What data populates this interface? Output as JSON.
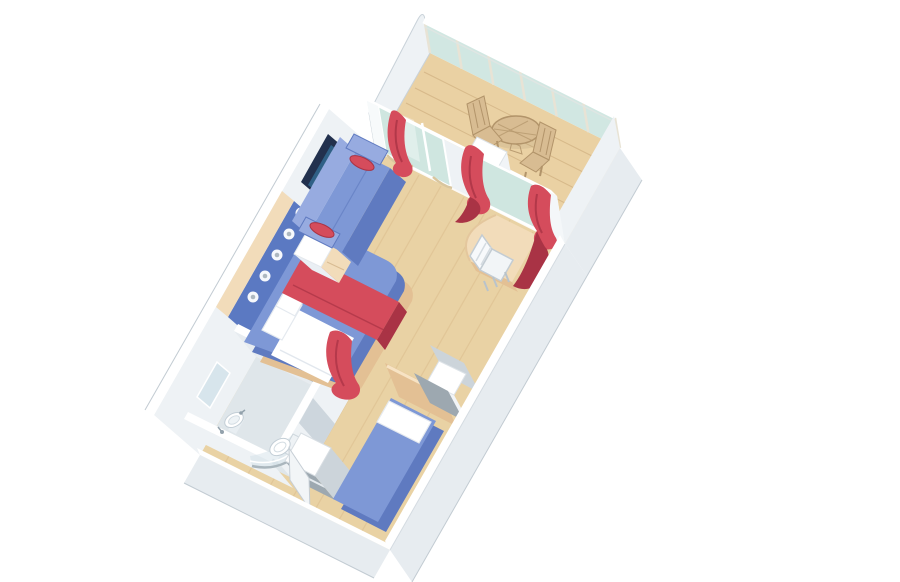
{
  "scene": {
    "view": "isometric-cutaway-floorplan",
    "subject": "Cruise ship stateroom with private balcony - 3D floor plan rendering",
    "background": "#ffffff"
  },
  "colors": {
    "carpet": "#e9d2a4",
    "carpetLine": "#d9ba8a",
    "deck": "#ead1a3",
    "deckLine": "#d2b383",
    "wall": "#eef2f5",
    "wallTop": "#ffffff",
    "wallBand": "#e7ecf0",
    "wallEdge": "#c2cbd2",
    "glass": "#cfe6e0",
    "glassFrame": "#e8e3d5",
    "blue": "#7e98d6",
    "blueDark": "#5f7ac0",
    "blueLight": "#97abe0",
    "headboard": "#5b79c2",
    "red": "#d54c5c",
    "redDark": "#a93345",
    "peach": "#f2dcba",
    "peachDeep": "#e3c094",
    "wood": "#d8bc92",
    "woodDark": "#b2946a",
    "tvFrame": "#22314e",
    "tvScreen": "#2f6086",
    "chrome": "#93a2ac",
    "fixFloor": "#dfe6ea",
    "nicheGray": "#9da8b0",
    "nicheLight": "#ccd4da"
  },
  "rooms": [
    {
      "name": "balcony"
    },
    {
      "name": "living-area"
    },
    {
      "name": "bedroom"
    },
    {
      "name": "bathroom"
    },
    {
      "name": "entrance-corridor"
    }
  ],
  "furniture": [
    {
      "name": "sofa-with-bolsters"
    },
    {
      "name": "wall-art-tv"
    },
    {
      "name": "queen-bed-with-runner"
    },
    {
      "name": "nightstand"
    },
    {
      "name": "headboard-with-reading-lights"
    },
    {
      "name": "vanity-desk"
    },
    {
      "name": "desk-chair"
    },
    {
      "name": "single-bed"
    },
    {
      "name": "wardrobe"
    },
    {
      "name": "closet-niche"
    },
    {
      "name": "balcony-round-table"
    },
    {
      "name": "balcony-chairs"
    },
    {
      "name": "washbasin"
    },
    {
      "name": "toilet"
    },
    {
      "name": "curved-shower"
    },
    {
      "name": "sliding-glass-door"
    },
    {
      "name": "red-curtains"
    }
  ],
  "counts": {
    "balustrade_glass_panels": 6,
    "balcony_chairs": 2,
    "sofa_bolsters": 2,
    "bed_pillows": 3,
    "red_curtains": 5,
    "reading_lights": 5
  }
}
